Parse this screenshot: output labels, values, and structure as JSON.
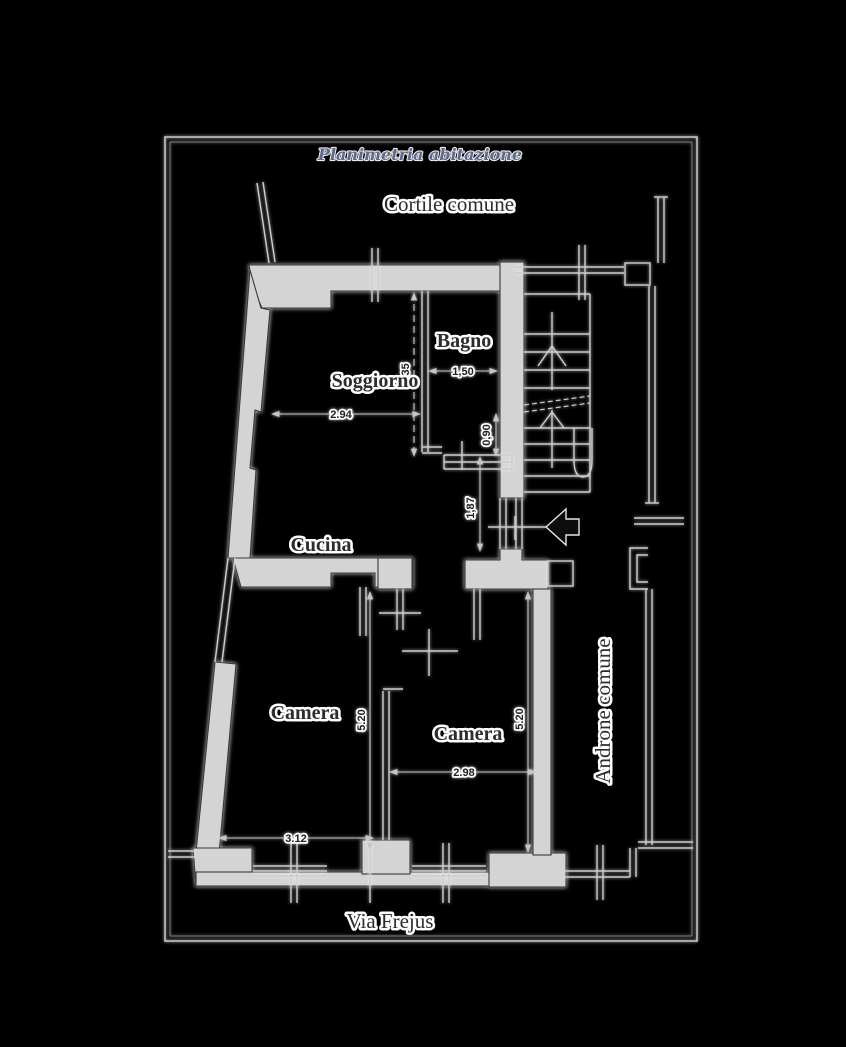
{
  "title": "Planimetria abitazione",
  "areas": {
    "courtyard": "Cortile comune",
    "entrance_hall": "Androne comune",
    "street": "Via Frejus"
  },
  "rooms": {
    "living_room": "Soggiorno",
    "bathroom": "Bagno",
    "kitchen": "Cucina",
    "bedroom_left": "Camera",
    "bedroom_right": "Camera"
  },
  "dims": {
    "living_width": "2.94",
    "bath_width": "1,50",
    "bath_height": "3,35",
    "bath_door_width": "0,90",
    "hall_passage": "1,87",
    "bedroom_left_width": "3.12",
    "bedroom_left_height": "5.20",
    "bedroom_right_width": "2.98",
    "bedroom_right_height": "5.20"
  },
  "icons": {
    "entrance_arrow": "entrance-direction-arrow"
  },
  "colors": {
    "background": "#000000",
    "wall_fill": "#d4d4d4",
    "wall_outline": "#3a3a3a",
    "line": "#cccccc",
    "text": "#2d2d2d",
    "halo": "#ffffff",
    "title_color": "#5a6a94",
    "frame": "#c2c2c2",
    "entrance_arrow": "#0d0d0d"
  }
}
